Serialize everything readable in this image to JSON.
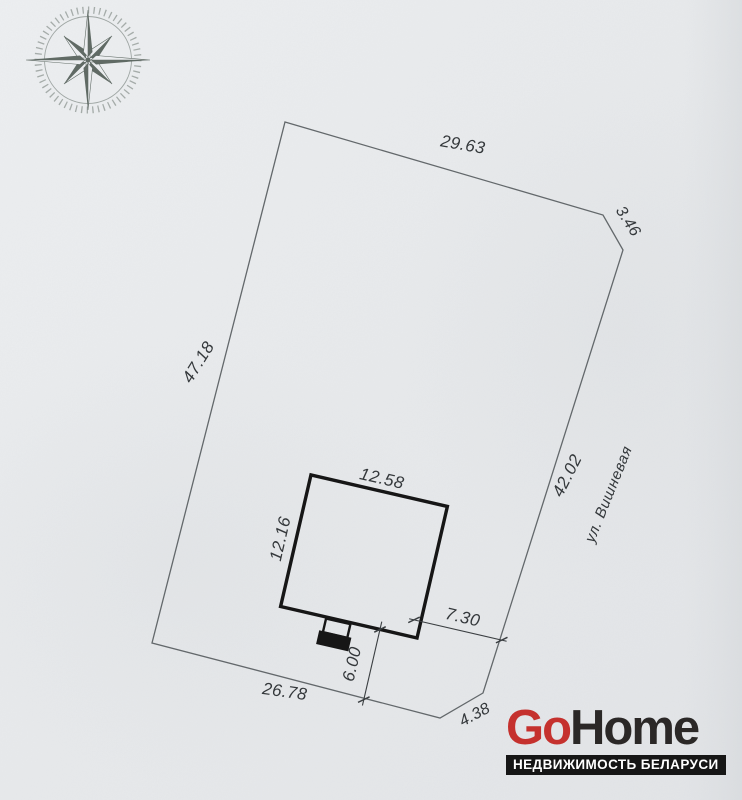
{
  "plan": {
    "street_label": "ул. Вишневая",
    "boundary_dims": {
      "top": "29.63",
      "top_right": "3.46",
      "right": "42.02",
      "left": "47.18",
      "bottom": "26.78",
      "bottom_right": "4.38"
    },
    "house_dims": {
      "width": "12.58",
      "depth": "12.16",
      "to_street": "7.30",
      "to_front_boundary": "6.00"
    }
  },
  "logo": {
    "go": "Go",
    "home": "Home",
    "tagline": "НЕДВИЖИМОСТЬ БЕЛАРУСИ"
  },
  "icons": {
    "compass_rose": "8-point compass star with ticked ring"
  },
  "colors": {
    "paper": "#e8eaec",
    "line": "#63686b",
    "draw": "#3a3e41",
    "house_line": "#161616",
    "text": "#34383b",
    "compass": "#4d5952",
    "logo_red": "#c5312e",
    "logo_dark": "#2b2827",
    "bar_bg": "#161616",
    "bar_text": "#ffffff"
  }
}
